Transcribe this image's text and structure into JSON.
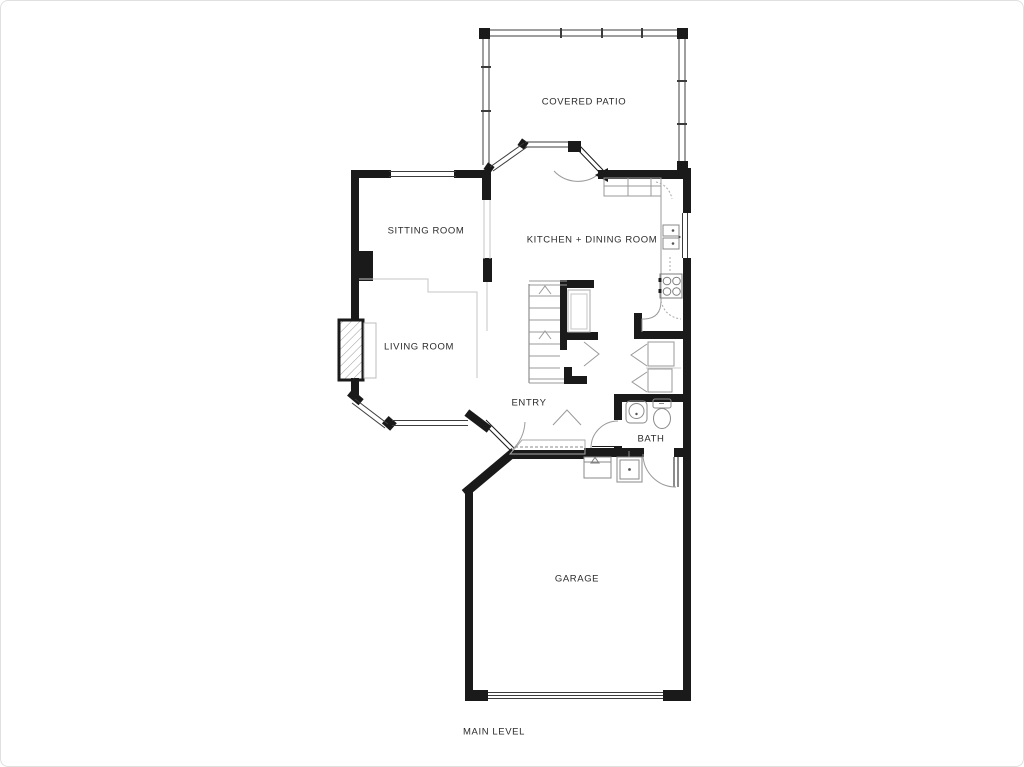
{
  "colors": {
    "wall": "#1a1a1a",
    "window_line": "#3c3c3c",
    "fixture_line": "#8a8a8a",
    "soffit_line": "#c6c6c6",
    "text": "#2b2b2b",
    "background": "#ffffff"
  },
  "plan": {
    "level_label": "MAIN LEVEL",
    "rooms": {
      "covered_patio": "COVERED PATIO",
      "sitting_room": "SITTING ROOM",
      "kitchen_dining": "KITCHEN + DINING ROOM",
      "living_room": "LIVING ROOM",
      "entry": "ENTRY",
      "bath": "BATH",
      "garage": "GARAGE"
    },
    "fixtures": [
      "stairs-up",
      "kitchen-double-sink",
      "range-cooktop",
      "kitchen-counter",
      "pantry-closet",
      "coat-closet",
      "linen-closets",
      "pedestal-sink",
      "toilet",
      "water-heater",
      "utility-sink",
      "fireplace",
      "bay-window",
      "garage-vehicle-door",
      "patio-screen-walls"
    ]
  }
}
